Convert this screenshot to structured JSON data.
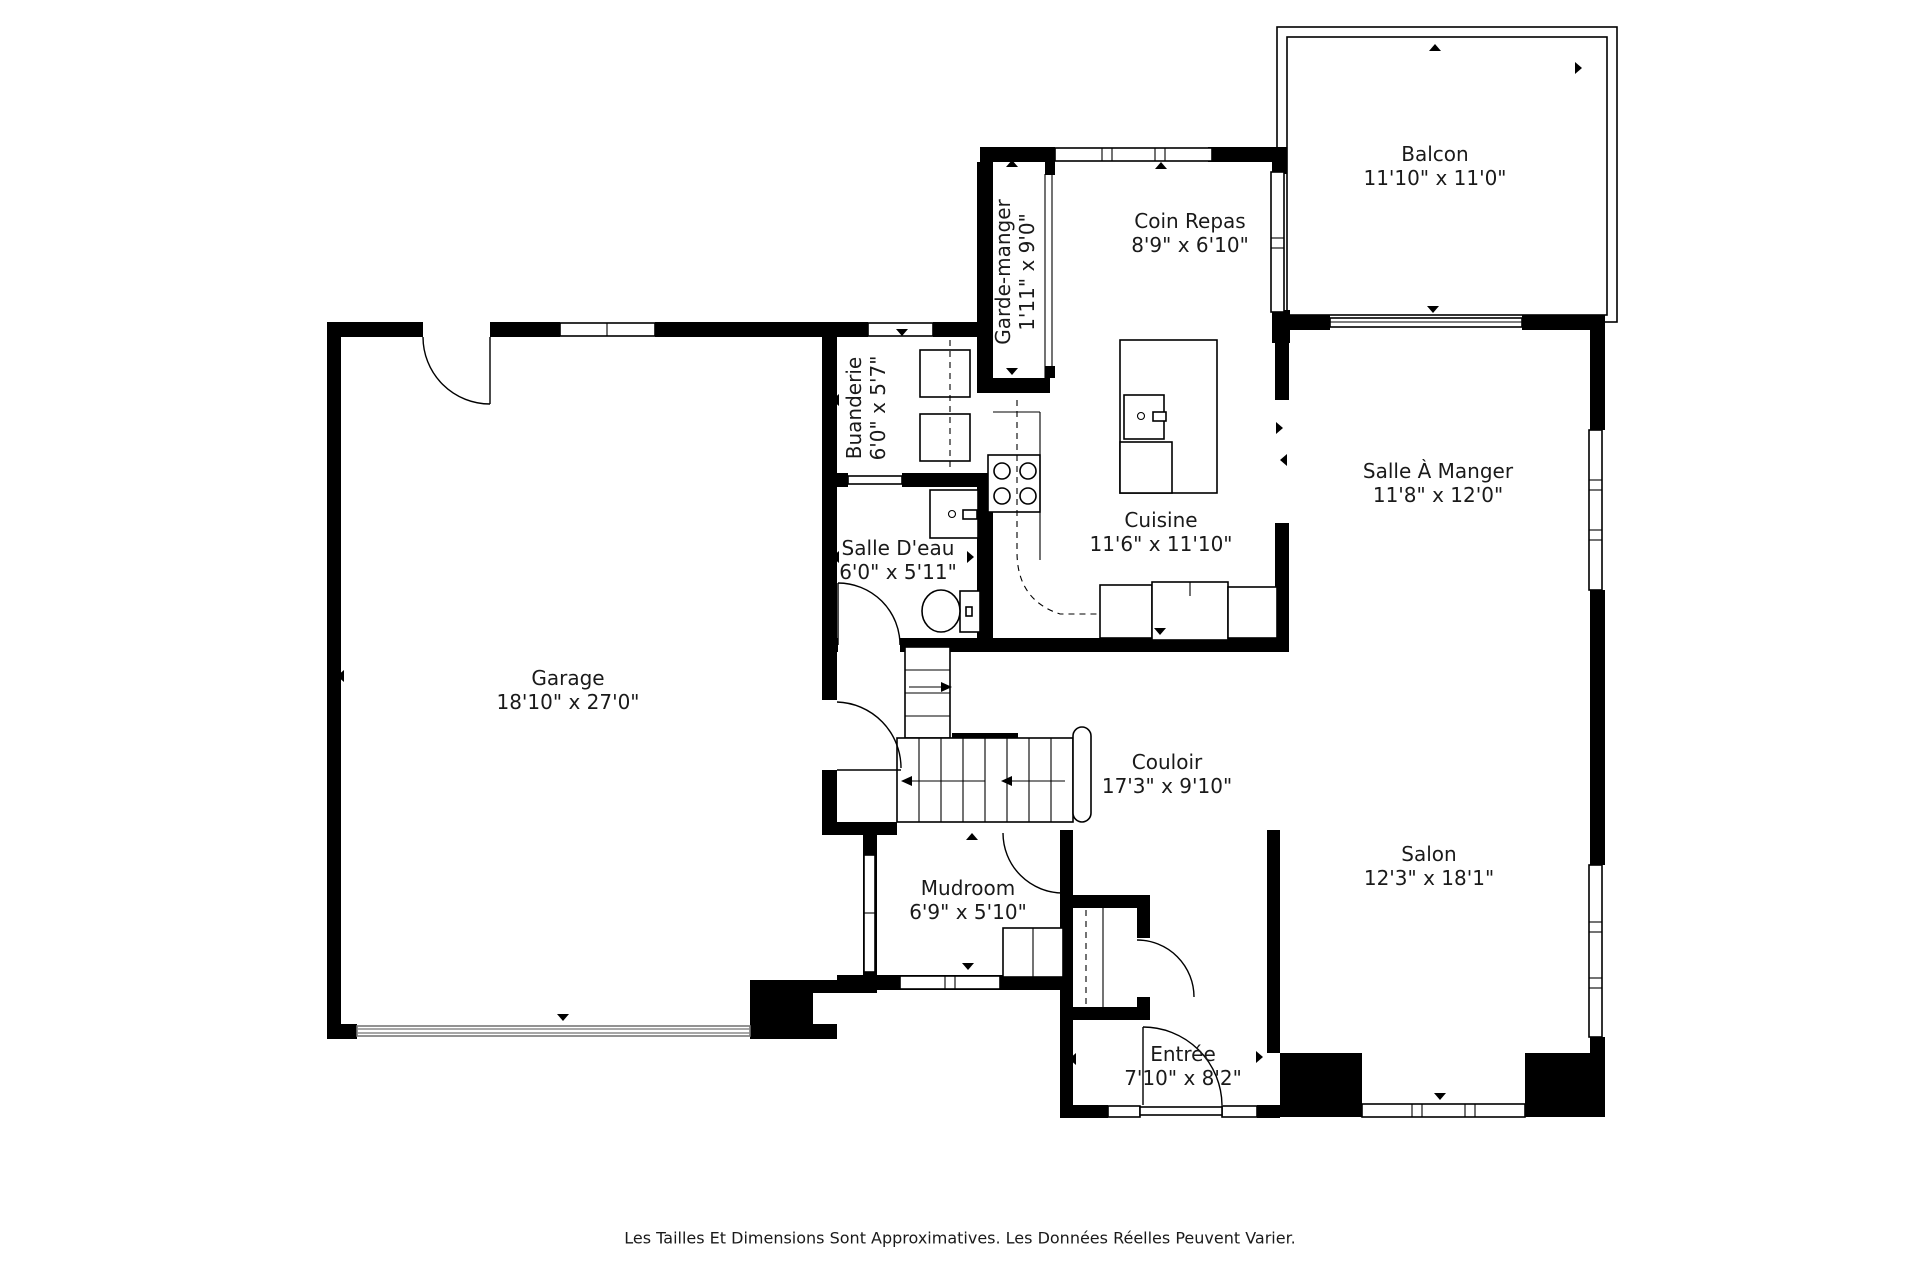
{
  "plan": {
    "rooms": {
      "balcon": {
        "name": "Balcon",
        "dims": "11'10\" x 11'0\""
      },
      "coin_repas": {
        "name": "Coin Repas",
        "dims": "8'9\" x 6'10\""
      },
      "garde_manger": {
        "name": "Garde-manger",
        "dims": "1'11\" x 9'0\""
      },
      "buanderie": {
        "name": "Buanderie",
        "dims": "6'0\" x 5'7\""
      },
      "salle_deau": {
        "name": "Salle D'eau",
        "dims": "6'0\" x 5'11\""
      },
      "cuisine": {
        "name": "Cuisine",
        "dims": "11'6\" x 11'10\""
      },
      "salle_a_manger": {
        "name": "Salle À Manger",
        "dims": "11'8\" x 12'0\""
      },
      "garage": {
        "name": "Garage",
        "dims": "18'10\" x 27'0\""
      },
      "couloir": {
        "name": "Couloir",
        "dims": "17'3\" x 9'10\""
      },
      "mudroom": {
        "name": "Mudroom",
        "dims": "6'9\" x 5'10\""
      },
      "salon": {
        "name": "Salon",
        "dims": "12'3\" x 18'1\""
      },
      "entree": {
        "name": "Entrée",
        "dims": "7'10\" x 8'2\""
      }
    },
    "disclaimer": "Les Tailles Et Dimensions Sont Approximatives. Les Données Réelles Peuvent Varier.",
    "colors": {
      "wall": "#000000",
      "background": "#ffffff",
      "text": "#1a1a1a"
    }
  }
}
